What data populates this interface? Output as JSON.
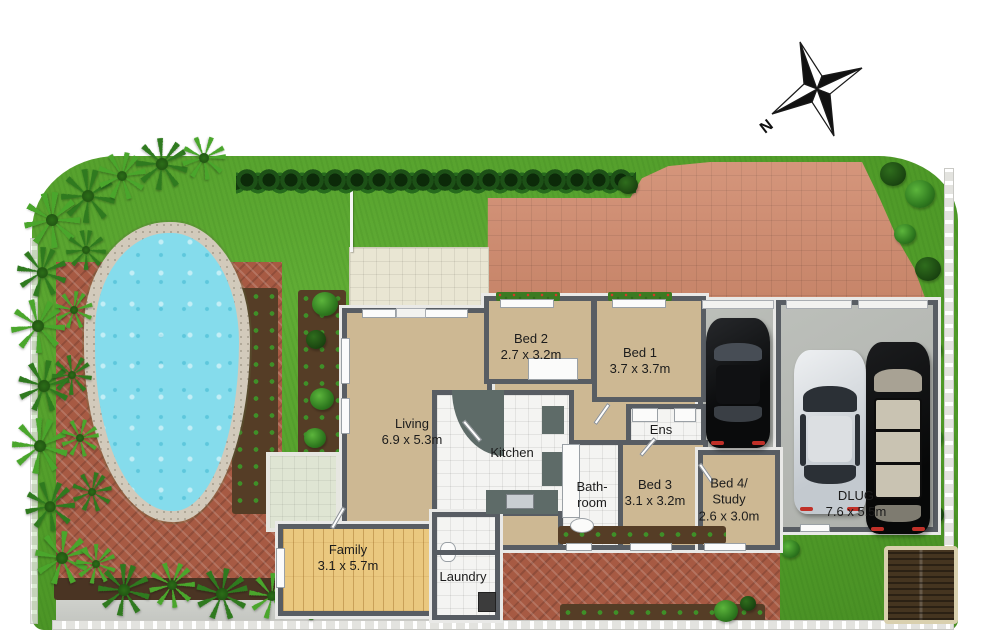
{
  "compass": {
    "north_label": "N"
  },
  "rooms": {
    "living": {
      "name": "Living",
      "dims": "6.9 x 5.3m"
    },
    "kitchen": {
      "name": "Kitchen"
    },
    "bed1": {
      "name": "Bed 1",
      "dims": "3.7 x 3.7m"
    },
    "bed2": {
      "name": "Bed 2",
      "dims": "2.7 x 3.2m"
    },
    "bed3": {
      "name": "Bed 3",
      "dims": "3.1 x 3.2m"
    },
    "bed4": {
      "name_line1": "Bed 4/",
      "name_line2": "Study",
      "dims": "2.6 x 3.0m"
    },
    "ensuite": {
      "name": "Ens"
    },
    "bathroom": {
      "name_line1": "Bath-",
      "name_line2": "room"
    },
    "family": {
      "name": "Family",
      "dims": "3.1 x 5.7m"
    },
    "laundry": {
      "name": "Laundry"
    },
    "garage": {
      "name": "DLUG",
      "dims": "7.6 x 5.5m"
    }
  },
  "palette": {
    "lawn": "#4f9a28",
    "pool_water": "#85dcec",
    "pool_edge": "#d2cabb",
    "brick_paving": "#a75a43",
    "driveway_paving": "#d08a6d",
    "patio_paving": "#e9e6d3",
    "carpet": "#cdb893",
    "timber_floor": "#eac87f",
    "tile_floor": "#f4f4f2",
    "garage_floor": "#b4b7b2",
    "wall": "#585d63",
    "hedge": "#1d5117",
    "soil": "#553d26"
  }
}
